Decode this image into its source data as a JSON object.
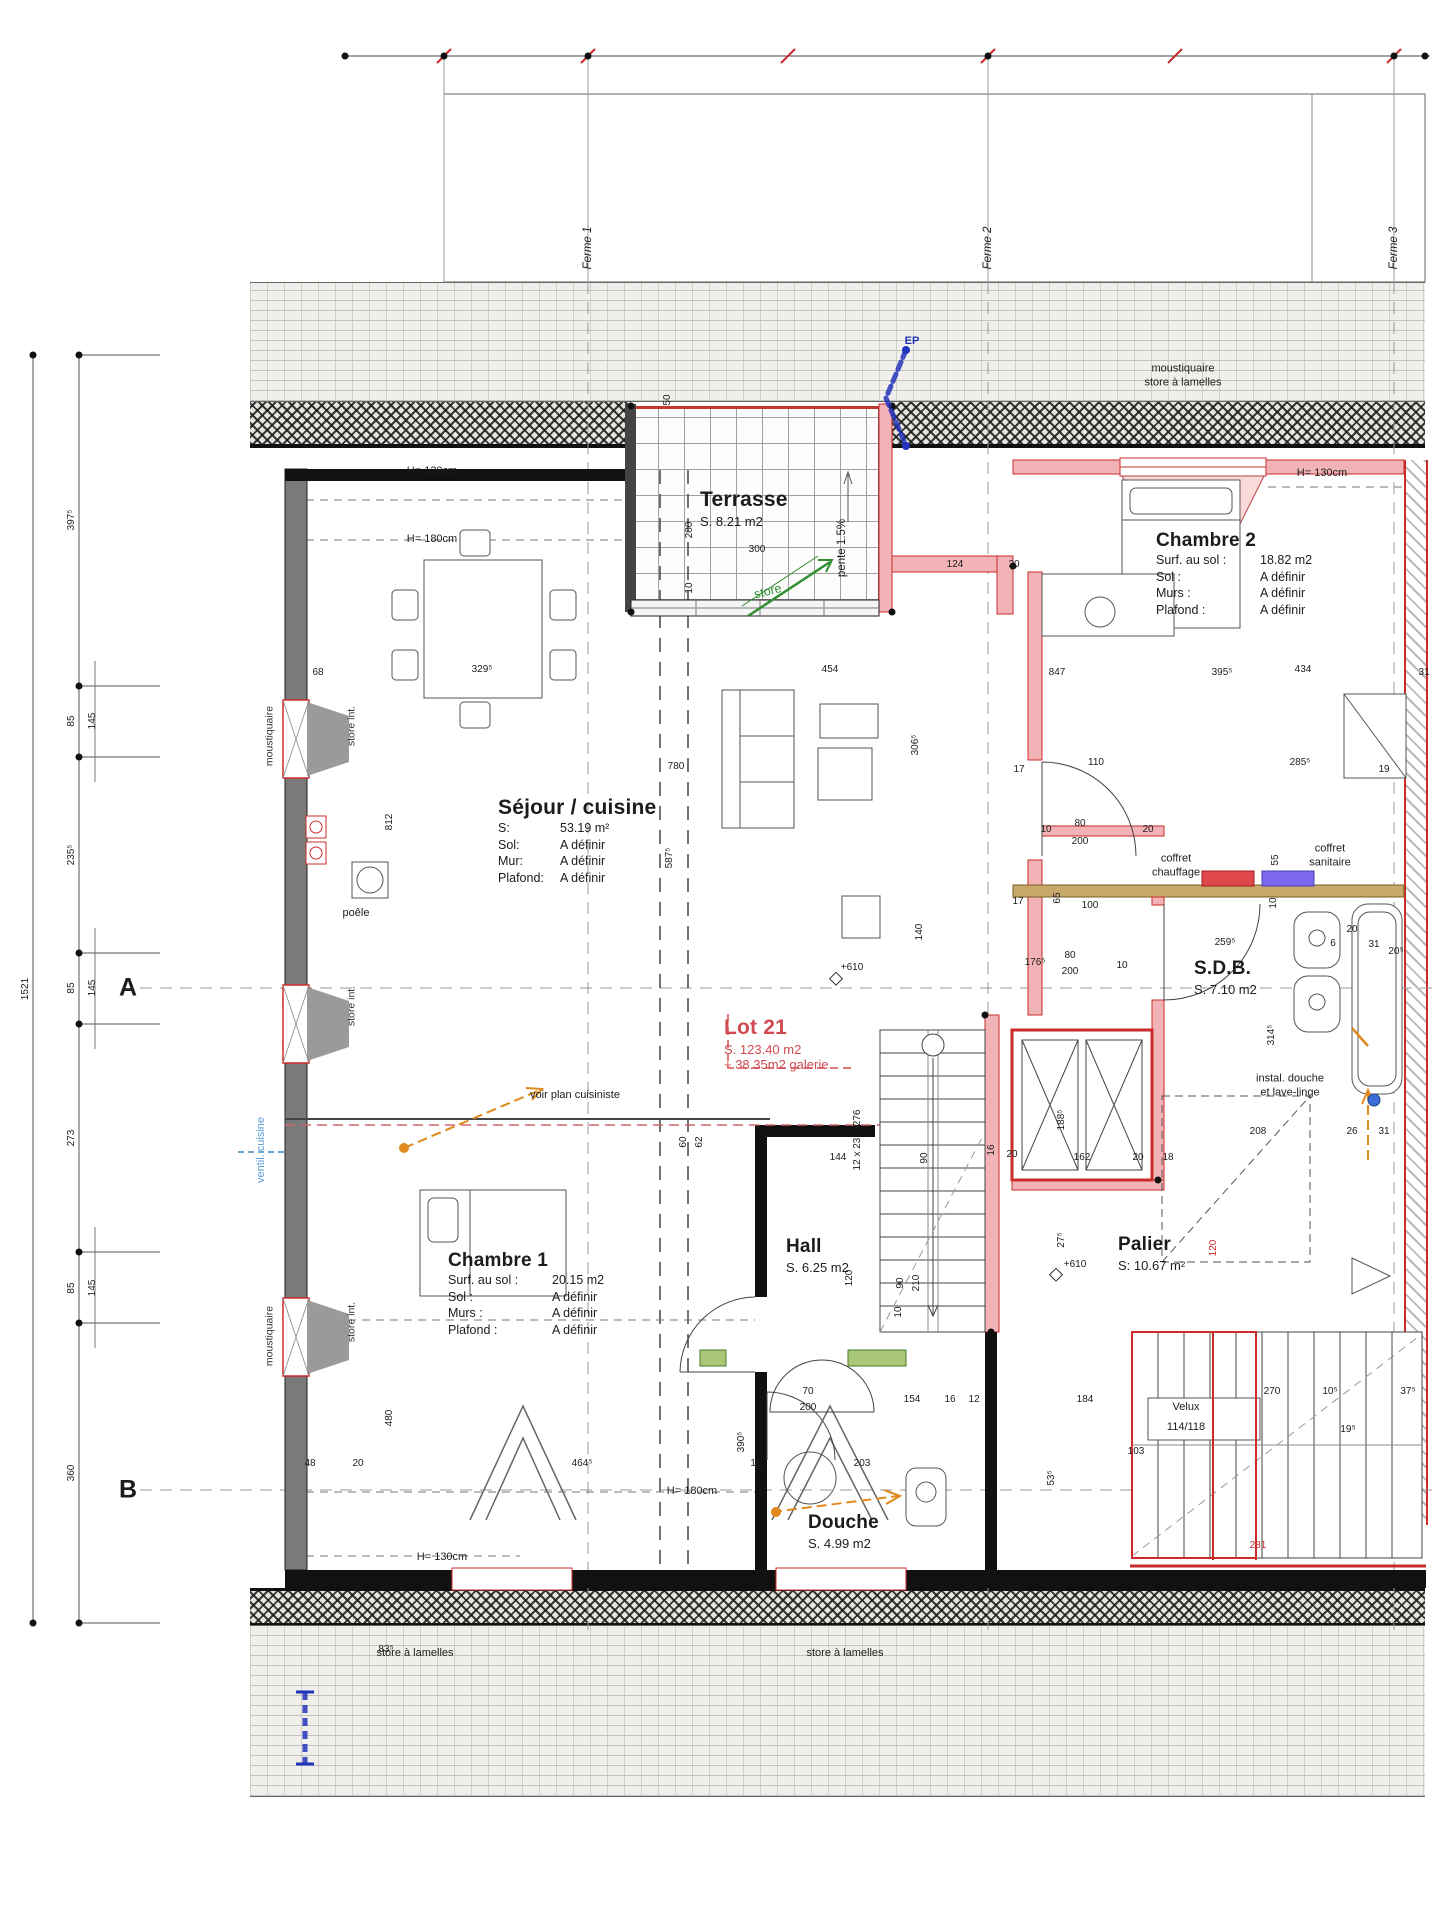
{
  "title": "Plan étage - Lot 21",
  "colors": {
    "accent_red": "#cc2b2b",
    "wall_pink": "#f2b3b7",
    "green": "#2f8f2f",
    "orange": "#e08a1e",
    "blue": "#2233bb",
    "light_blue": "#6fa8cc",
    "brown": "#c9a86b",
    "violet": "#7b68ee"
  },
  "rooms": {
    "terrasse": {
      "name": "Terrasse",
      "area": "S. 8.21 m2"
    },
    "sejour": {
      "name": "Séjour / cuisine",
      "rows": [
        {
          "k": "S:",
          "v": "53.19 m²"
        },
        {
          "k": "Sol:",
          "v": "A définir"
        },
        {
          "k": "Mur:",
          "v": "A définir"
        },
        {
          "k": "Plafond:",
          "v": "A définir"
        }
      ]
    },
    "chambre2": {
      "name": "Chambre 2",
      "rows": [
        {
          "k": "Surf. au sol :",
          "v": "18.82 m2"
        },
        {
          "k": "Sol :",
          "v": "A définir"
        },
        {
          "k": "Murs :",
          "v": "A définir"
        },
        {
          "k": "Plafond :",
          "v": "A définir"
        }
      ]
    },
    "chambre1": {
      "name": "Chambre 1",
      "rows": [
        {
          "k": "Surf. au sol :",
          "v": "20.15 m2"
        },
        {
          "k": "Sol :",
          "v": "A définir"
        },
        {
          "k": "Murs :",
          "v": "A définir"
        },
        {
          "k": "Plafond :",
          "v": "A définir"
        }
      ]
    },
    "sdb": {
      "name": "S.D.B.",
      "area": "S. 7.10 m2"
    },
    "hall": {
      "name": "Hall",
      "area": "S. 6.25 m2"
    },
    "palier": {
      "name": "Palier",
      "area": "S: 10.67 m²"
    },
    "douche": {
      "name": "Douche",
      "area": "S. 4.99 m2"
    },
    "lot21": {
      "name": "Lot 21",
      "area": "S. 123.40 m2",
      "extra": "+ 38.35m2 galerie"
    }
  },
  "annotations": [
    {
      "x": 1183,
      "y": 376,
      "t": "moustiquaire\nstore à lamelles",
      "s": "annc"
    },
    {
      "x": 1176,
      "y": 866,
      "t": "coffret\nchauffage",
      "s": "annc"
    },
    {
      "x": 1330,
      "y": 856,
      "t": "coffret\nsanitaire",
      "s": "annc"
    },
    {
      "x": 1290,
      "y": 1086,
      "t": "instal. douche\net lave-linge",
      "s": "annc"
    },
    {
      "x": 575,
      "y": 1096,
      "t": "voir plan cuisiniste",
      "s": "ann"
    },
    {
      "x": 262,
      "y": 1150,
      "t": "ventil. cuisine",
      "s": "vblue"
    },
    {
      "x": 768,
      "y": 592,
      "t": "store",
      "s": "green"
    },
    {
      "x": 842,
      "y": 548,
      "t": "pente 1.5%",
      "s": "vp"
    },
    {
      "x": 912,
      "y": 342,
      "t": "EP",
      "s": "blue"
    },
    {
      "x": 356,
      "y": 914,
      "t": "poêle",
      "s": "ann"
    },
    {
      "x": 432,
      "y": 472,
      "t": "H= 130cm",
      "s": "ann"
    },
    {
      "x": 432,
      "y": 540,
      "t": "H= 180cm",
      "s": "ann"
    },
    {
      "x": 1322,
      "y": 474,
      "t": "H= 130cm",
      "s": "ann"
    },
    {
      "x": 692,
      "y": 1492,
      "t": "H= 180cm",
      "s": "ann"
    },
    {
      "x": 442,
      "y": 1558,
      "t": "H= 130cm",
      "s": "ann"
    },
    {
      "x": 352,
      "y": 726,
      "t": "store int.",
      "s": "vann"
    },
    {
      "x": 352,
      "y": 1006,
      "t": "store int.",
      "s": "vann"
    },
    {
      "x": 352,
      "y": 1322,
      "t": "store int.",
      "s": "vann"
    },
    {
      "x": 270,
      "y": 736,
      "t": "moustiquaire",
      "s": "vann"
    },
    {
      "x": 270,
      "y": 1336,
      "t": "moustiquaire",
      "s": "vann"
    },
    {
      "x": 415,
      "y": 1654,
      "t": "store à lamelles",
      "s": "ann"
    },
    {
      "x": 845,
      "y": 1654,
      "t": "store à lamelles",
      "s": "ann"
    },
    {
      "x": 588,
      "y": 248,
      "t": "Ferme 1",
      "s": "vferme"
    },
    {
      "x": 988,
      "y": 248,
      "t": "Ferme 2",
      "s": "vferme"
    },
    {
      "x": 1394,
      "y": 248,
      "t": "Ferme 3",
      "s": "vferme"
    },
    {
      "x": 128,
      "y": 988,
      "t": "A",
      "s": "axis"
    },
    {
      "x": 128,
      "y": 1490,
      "t": "B",
      "s": "axis"
    },
    {
      "x": 1186,
      "y": 1408,
      "t": "Velux",
      "s": "ann"
    },
    {
      "x": 1186,
      "y": 1428,
      "t": "114/118",
      "s": "ann"
    }
  ],
  "dims": [
    {
      "x": 668,
      "y": 400,
      "t": "50",
      "s": "v"
    },
    {
      "x": 690,
      "y": 530,
      "t": "200",
      "s": "v"
    },
    {
      "x": 690,
      "y": 588,
      "t": "10",
      "s": "v"
    },
    {
      "x": 757,
      "y": 550,
      "t": "300"
    },
    {
      "x": 955,
      "y": 565,
      "t": "124"
    },
    {
      "x": 1014,
      "y": 565,
      "t": "20"
    },
    {
      "x": 830,
      "y": 670,
      "t": "454"
    },
    {
      "x": 676,
      "y": 767,
      "t": "780"
    },
    {
      "x": 916,
      "y": 745,
      "t": "306⁵",
      "s": "v"
    },
    {
      "x": 482,
      "y": 670,
      "t": "329⁵"
    },
    {
      "x": 318,
      "y": 673,
      "t": "68"
    },
    {
      "x": 390,
      "y": 822,
      "t": "812",
      "s": "v"
    },
    {
      "x": 670,
      "y": 858,
      "t": "587⁵",
      "s": "v"
    },
    {
      "x": 1019,
      "y": 770,
      "t": "17"
    },
    {
      "x": 1096,
      "y": 763,
      "t": "110"
    },
    {
      "x": 1300,
      "y": 763,
      "t": "285⁵"
    },
    {
      "x": 1384,
      "y": 770,
      "t": "19"
    },
    {
      "x": 1222,
      "y": 673,
      "t": "395⁵"
    },
    {
      "x": 1303,
      "y": 670,
      "t": "434"
    },
    {
      "x": 1424,
      "y": 673,
      "t": "31"
    },
    {
      "x": 1057,
      "y": 673,
      "t": "847"
    },
    {
      "x": 1046,
      "y": 830,
      "t": "10"
    },
    {
      "x": 1080,
      "y": 824,
      "t": "80"
    },
    {
      "x": 1080,
      "y": 842,
      "t": "200"
    },
    {
      "x": 1148,
      "y": 830,
      "t": "20"
    },
    {
      "x": 1018,
      "y": 902,
      "t": "17"
    },
    {
      "x": 1058,
      "y": 898,
      "t": "65",
      "s": "v"
    },
    {
      "x": 1090,
      "y": 906,
      "t": "100"
    },
    {
      "x": 1035,
      "y": 963,
      "t": "176⁵"
    },
    {
      "x": 1070,
      "y": 956,
      "t": "80"
    },
    {
      "x": 1070,
      "y": 972,
      "t": "200"
    },
    {
      "x": 1122,
      "y": 966,
      "t": "10"
    },
    {
      "x": 1225,
      "y": 943,
      "t": "259⁵"
    },
    {
      "x": 1276,
      "y": 860,
      "t": "55",
      "s": "v"
    },
    {
      "x": 1274,
      "y": 903,
      "t": "10",
      "s": "v"
    },
    {
      "x": 1352,
      "y": 930,
      "t": "20"
    },
    {
      "x": 1333,
      "y": 944,
      "t": "6"
    },
    {
      "x": 1374,
      "y": 945,
      "t": "31"
    },
    {
      "x": 1396,
      "y": 952,
      "t": "20⁵"
    },
    {
      "x": 1272,
      "y": 1035,
      "t": "314⁵",
      "s": "v"
    },
    {
      "x": 920,
      "y": 932,
      "t": "140",
      "s": "v"
    },
    {
      "x": 852,
      "y": 968,
      "t": "+610"
    },
    {
      "x": 838,
      "y": 1158,
      "t": "144"
    },
    {
      "x": 925,
      "y": 1158,
      "t": "90",
      "s": "v"
    },
    {
      "x": 992,
      "y": 1150,
      "t": "16",
      "s": "v"
    },
    {
      "x": 1012,
      "y": 1155,
      "t": "20"
    },
    {
      "x": 1082,
      "y": 1158,
      "t": "162"
    },
    {
      "x": 1138,
      "y": 1158,
      "t": "20"
    },
    {
      "x": 1168,
      "y": 1158,
      "t": "18"
    },
    {
      "x": 1062,
      "y": 1120,
      "t": "188⁵",
      "s": "v"
    },
    {
      "x": 1258,
      "y": 1132,
      "t": "208"
    },
    {
      "x": 1352,
      "y": 1132,
      "t": "26"
    },
    {
      "x": 1384,
      "y": 1132,
      "t": "31"
    },
    {
      "x": 1062,
      "y": 1240,
      "t": "27⁵",
      "s": "v"
    },
    {
      "x": 1075,
      "y": 1265,
      "t": "+610"
    },
    {
      "x": 1214,
      "y": 1248,
      "t": "120",
      "s": "vr"
    },
    {
      "x": 850,
      "y": 1278,
      "t": "120",
      "s": "v"
    },
    {
      "x": 901,
      "y": 1283,
      "t": "90",
      "s": "v"
    },
    {
      "x": 917,
      "y": 1283,
      "t": "210",
      "s": "v"
    },
    {
      "x": 899,
      "y": 1312,
      "t": "10",
      "s": "v"
    },
    {
      "x": 858,
      "y": 1140,
      "t": "12 x 23 = 276",
      "s": "v"
    },
    {
      "x": 808,
      "y": 1392,
      "t": "70"
    },
    {
      "x": 808,
      "y": 1408,
      "t": "200"
    },
    {
      "x": 758,
      "y": 1464,
      "t": "15⁵"
    },
    {
      "x": 862,
      "y": 1464,
      "t": "203"
    },
    {
      "x": 912,
      "y": 1400,
      "t": "154"
    },
    {
      "x": 950,
      "y": 1400,
      "t": "16"
    },
    {
      "x": 974,
      "y": 1400,
      "t": "12"
    },
    {
      "x": 1085,
      "y": 1400,
      "t": "184"
    },
    {
      "x": 1052,
      "y": 1478,
      "t": "53⁵",
      "s": "v"
    },
    {
      "x": 1272,
      "y": 1392,
      "t": "270"
    },
    {
      "x": 1330,
      "y": 1392,
      "t": "10⁵"
    },
    {
      "x": 1408,
      "y": 1392,
      "t": "37⁵"
    },
    {
      "x": 1348,
      "y": 1430,
      "t": "19⁵"
    },
    {
      "x": 1136,
      "y": 1452,
      "t": "103"
    },
    {
      "x": 582,
      "y": 1464,
      "t": "464⁵"
    },
    {
      "x": 742,
      "y": 1442,
      "t": "390⁵",
      "s": "v"
    },
    {
      "x": 310,
      "y": 1464,
      "t": "48"
    },
    {
      "x": 358,
      "y": 1464,
      "t": "20"
    },
    {
      "x": 390,
      "y": 1418,
      "t": "480",
      "s": "v"
    },
    {
      "x": 386,
      "y": 1650,
      "t": "83⁵"
    },
    {
      "x": 684,
      "y": 1142,
      "t": "60",
      "s": "v"
    },
    {
      "x": 700,
      "y": 1142,
      "t": "62",
      "s": "v"
    },
    {
      "x": 1258,
      "y": 1546,
      "t": "281",
      "s": "hr"
    },
    {
      "x": 72,
      "y": 520,
      "t": "397⁵",
      "s": "v"
    },
    {
      "x": 72,
      "y": 721,
      "t": "85",
      "s": "v"
    },
    {
      "x": 93,
      "y": 721,
      "t": "145",
      "s": "v"
    },
    {
      "x": 72,
      "y": 855,
      "t": "235⁵",
      "s": "v"
    },
    {
      "x": 72,
      "y": 988,
      "t": "85",
      "s": "v"
    },
    {
      "x": 93,
      "y": 988,
      "t": "145",
      "s": "v"
    },
    {
      "x": 72,
      "y": 1138,
      "t": "273",
      "s": "v"
    },
    {
      "x": 72,
      "y": 1288,
      "t": "85",
      "s": "v"
    },
    {
      "x": 93,
      "y": 1288,
      "t": "145",
      "s": "v"
    },
    {
      "x": 72,
      "y": 1473,
      "t": "360",
      "s": "v"
    },
    {
      "x": 26,
      "y": 989,
      "t": "1521",
      "s": "v"
    }
  ]
}
